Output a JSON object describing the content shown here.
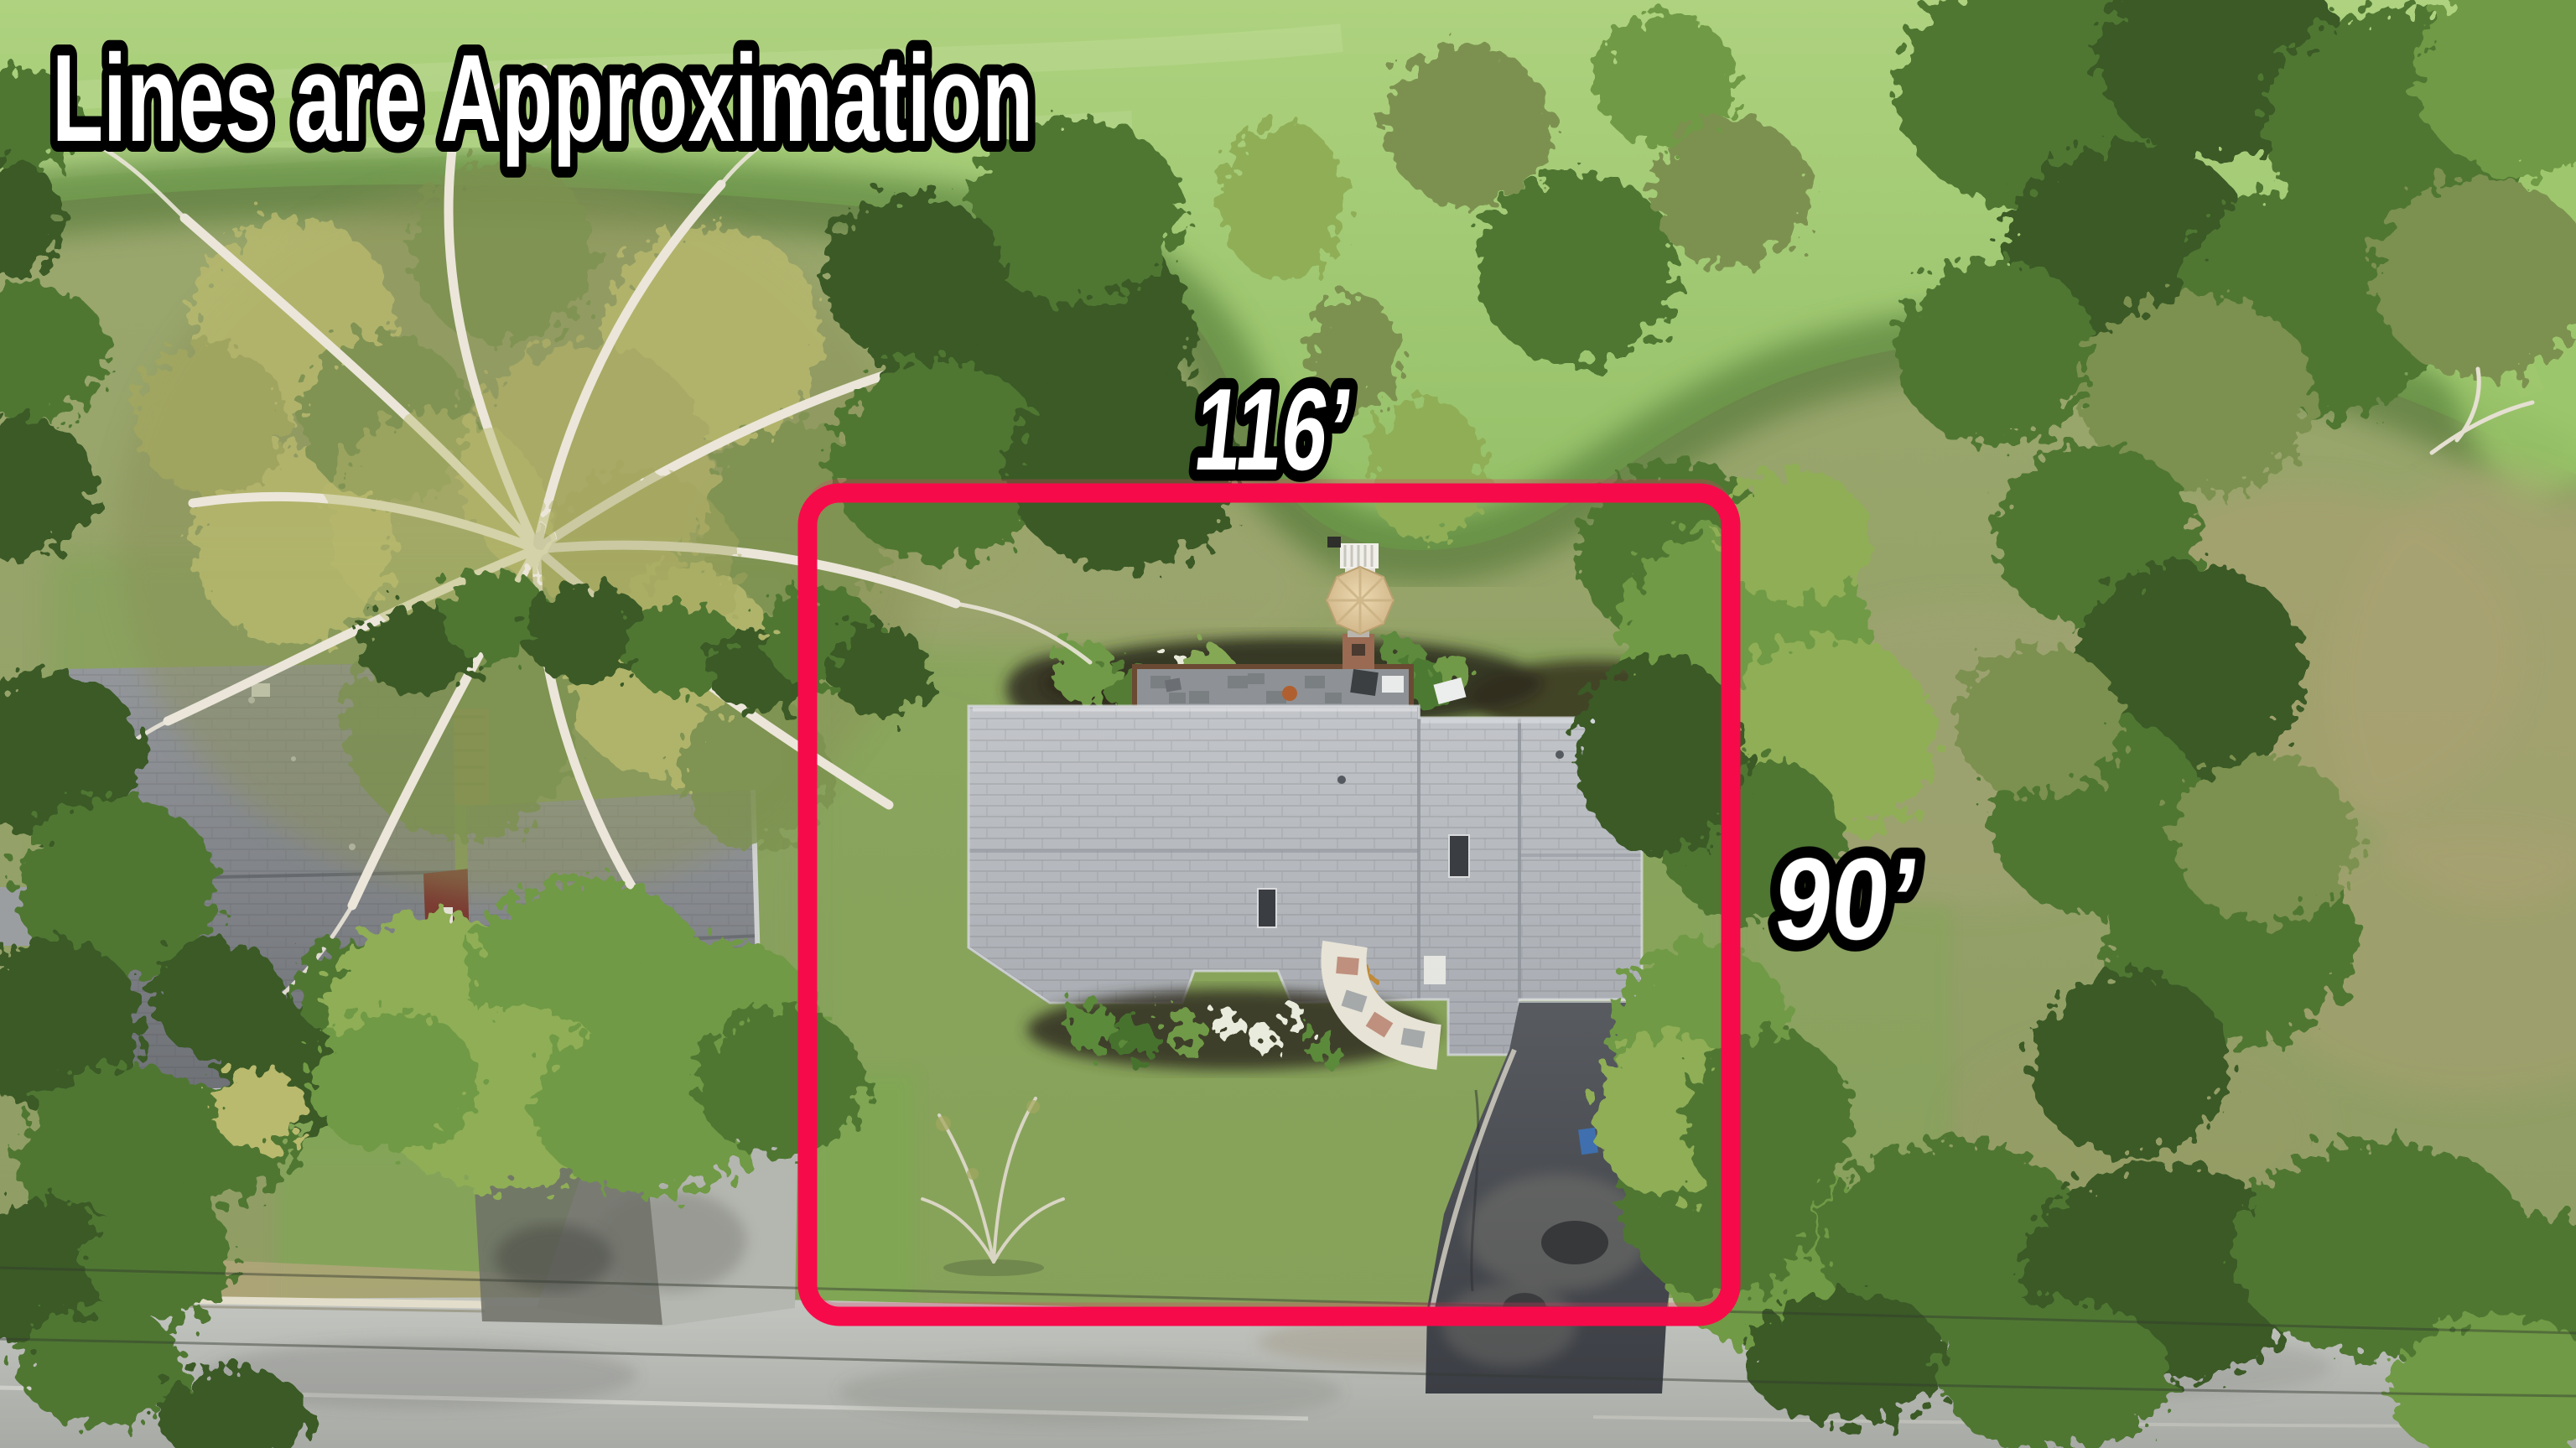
{
  "annotations": {
    "disclaimer": "Lines are Approximation",
    "top_dimension": "116’",
    "side_dimension": "90’",
    "line_color": "#f70a4a",
    "ghost_line_color": "#e23b64",
    "text_color": "#ffffff",
    "text_outline_color": "#000000"
  },
  "scene": {
    "description": "Aerial drone view of a suburban lot with red approximate boundary box",
    "palette": {
      "fairway_green": "#a3cb77",
      "rough_grass": "#96a06b",
      "lawn_green": "#7ca84f",
      "subject_roof_gray": "#b6bac0",
      "neighbor_roof_gray": "#85888d",
      "asphalt_driveway": "#45484e",
      "road_gray": "#b7b9b3",
      "umbrella_tan": "#dcc496",
      "mulch_brown": "#2f2b1d",
      "tree_dark_green": "#3a5a27",
      "tree_light_green": "#8fae57"
    }
  }
}
